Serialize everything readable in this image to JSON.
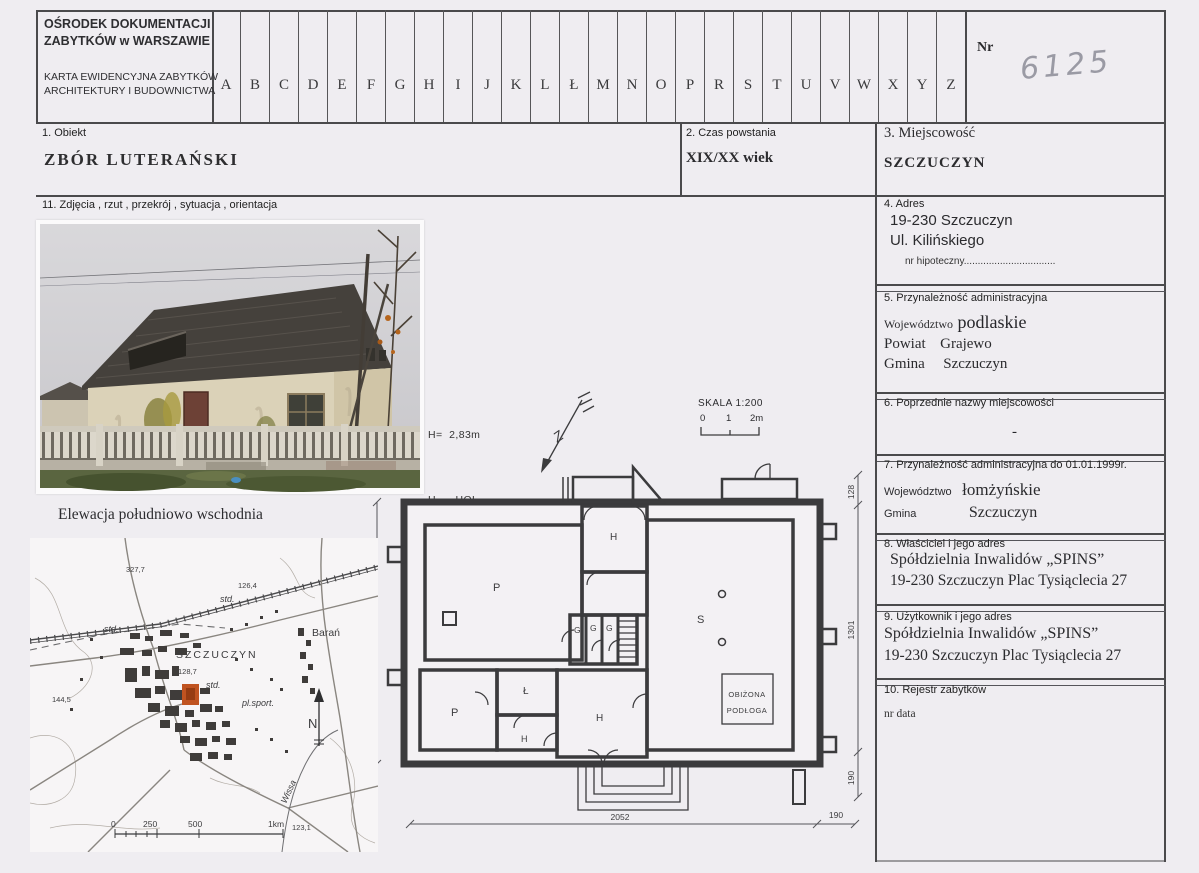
{
  "header": {
    "org_line1": "OŚRODEK DOKUMENTACJI",
    "org_line2": "ZABYTKÓW w WARSZAWIE",
    "card_line1": "KARTA EWIDENCYJNA ZABYTKÓW",
    "card_line2": "ARCHITEKTURY I BUDOWNICTWA",
    "letters": [
      "A",
      "B",
      "C",
      "D",
      "E",
      "F",
      "G",
      "H",
      "I",
      "J",
      "K",
      "L",
      "Ł",
      "M",
      "N",
      "O",
      "P",
      "R",
      "S",
      "T",
      "U",
      "V",
      "W",
      "X",
      "Y",
      "Z"
    ],
    "nr_label": "Nr",
    "nr_value": "6125"
  },
  "row2": {
    "f1_label": "1. Obiekt",
    "f1_value": "ZBÓR  LUTERAŃSKI",
    "f2_label": "2. Czas powstania",
    "f2_value": "XIX/XX wiek",
    "f3_label": "3. Miejscowość",
    "f3_value": "SZCZUCZYN"
  },
  "section11": {
    "label": "11. Zdjęcia , rzut , przekrój , sytuacja , orientacja",
    "photo_caption": "Elewacja  południowo wschodnia"
  },
  "legend": {
    "height_line": "H=  2,83m",
    "item1": "H  –  HOL",
    "item2": "P  –  POKÓJ",
    "item3": "Ł  –  ŁAZIENKA",
    "item4": "G  –  POM. GOSPODARCZE",
    "item5": "S  –  SALA"
  },
  "north_plan": {
    "letter": "Z"
  },
  "scalebox": {
    "label": "SKALA  1:200",
    "t0": "0",
    "t1": "1",
    "t2": "2m"
  },
  "plan": {
    "room_p1": "P",
    "room_p2": "P",
    "room_l": "Ł",
    "room_h_top": "H",
    "room_h_bottom": "H",
    "room_h_small": "H",
    "room_g1": "G",
    "room_g2": "G",
    "room_g3": "G",
    "room_s": "S",
    "note_line1": "OBIŻONA",
    "note_line2": "PODŁOGA",
    "dim_left": "1301",
    "dim_right_top": "128",
    "dim_right_mid": "1301",
    "dim_right_bottom": "190",
    "dim_bottom": "2052",
    "dim_bottom_right": "190"
  },
  "map": {
    "h1": "327,7",
    "h2": "126,4",
    "h3": "128,7",
    "h4": "144,5",
    "h5": "123,1",
    "std1": "std.",
    "std2": "std.",
    "std3": "std.",
    "town": "SZCZUCZYN",
    "village": "Barań",
    "sport": "pl.sport.",
    "river": "Wissa",
    "north": "N",
    "s0": "0",
    "s250": "250",
    "s500": "500",
    "s1km": "1km"
  },
  "right": {
    "s4": {
      "label": "4.  Adres",
      "line1": "19-230 Szczuczyn",
      "line2": "Ul. Kilińskiego",
      "hip": "nr hipoteczny................................."
    },
    "s5": {
      "label": "5.    Przynależność administracyjna",
      "rows": [
        {
          "k": "Województwo",
          "v": "podlaskie"
        },
        {
          "k": "Powiat",
          "v": "Grajewo"
        },
        {
          "k": "Gmina",
          "v": "Szczuczyn"
        }
      ]
    },
    "s6": {
      "label": "6.  Poprzednie nazwy miejscowości",
      "value": "-"
    },
    "s7": {
      "label": "7.    Przynależność administracyjna do 01.01.1999r.",
      "rows": [
        {
          "k": "Województwo",
          "v": "łomżyńskie"
        },
        {
          "k": "Gmina",
          "v": "Szczuczyn"
        }
      ]
    },
    "s8": {
      "label": "8.     Właściciel i jego adres",
      "line1": "Spółdzielnia Inwalidów „SPINS”",
      "line2": "19-230 Szczuczyn Plac Tysiąclecia 27"
    },
    "s9": {
      "label": "9. Użytkownik i jego adres",
      "line1": "Spółdzielnia Inwalidów „SPINS”",
      "line2": "19-230 Szczuczyn Plac Tysiąclecia 27"
    },
    "s10": {
      "label": "10. Rejestr zabytków",
      "note": "nr data"
    }
  },
  "colors": {
    "highlight_building": "#c05320",
    "pencil": "#9a9aa4",
    "grid_line": "#4a4a4c"
  }
}
